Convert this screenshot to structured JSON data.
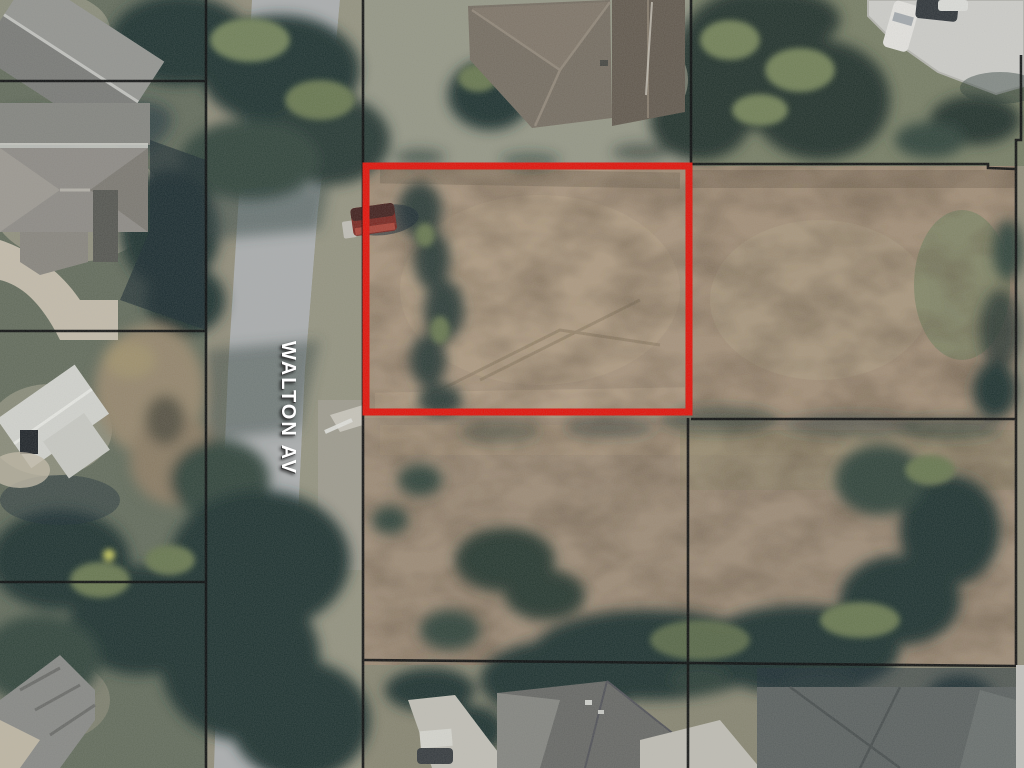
{
  "street": {
    "label": "WALTON AV",
    "label_color": "#ffffff"
  },
  "colors": {
    "boundary_red": "#e8150b",
    "parcel_line": "#0c0c0c",
    "field_tan": "#ad9880",
    "field_tan_right": "#a8937b",
    "field_tan_lower": "#a3907a",
    "lawn_green": "#9b9c8a",
    "road_gray": "#b2b4b4",
    "tree_dark": "#243530",
    "concrete": "#d5d4cf"
  }
}
